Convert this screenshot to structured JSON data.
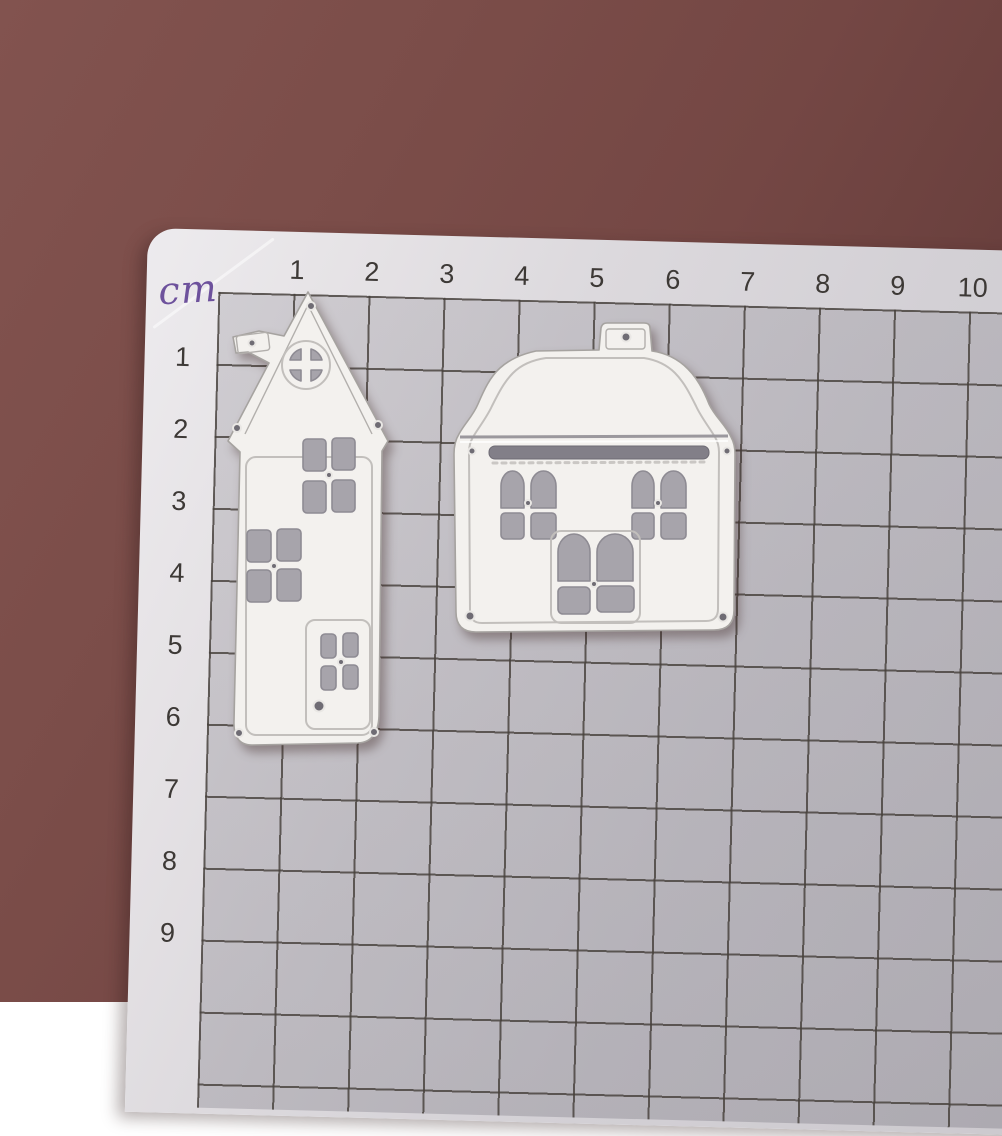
{
  "mat": {
    "unit_label": "cm",
    "ruler_top": [
      "1",
      "2",
      "3",
      "4",
      "5",
      "6",
      "7",
      "8",
      "9",
      "10"
    ],
    "ruler_left": [
      "1",
      "2",
      "3",
      "4",
      "5",
      "6",
      "7",
      "8",
      "9"
    ],
    "grid_cell_cm": 1
  },
  "objects": {
    "left_die": "tall-house-cutting-die",
    "right_die": "dome-house-cutting-die",
    "material": "metal-die-on-cutting-mat"
  },
  "colors": {
    "backdrop": "#7a4c48",
    "mat_margin": "#e6e3e6",
    "mat_grid_area": "#c4c1c6",
    "grid_line": "#46403b",
    "ruler_text": "#3d3936",
    "unit_text": "#6d519c",
    "die_metal": "#f3f1ee",
    "die_edge": "#a6a3a0",
    "cutout": "#a7a4ab"
  }
}
